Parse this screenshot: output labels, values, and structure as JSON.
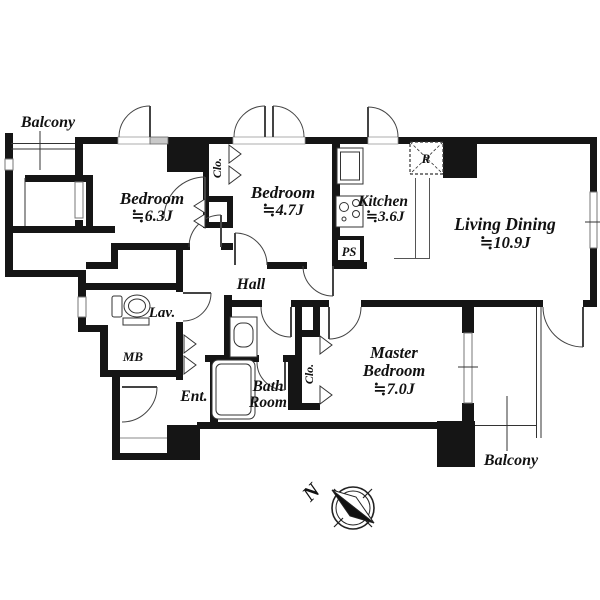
{
  "floorplan": {
    "rooms": {
      "balcony_top": {
        "label": "Balcony"
      },
      "bedroom_1": {
        "name": "Bedroom",
        "size": "≒6.3J"
      },
      "closet_top": {
        "label": "Clo."
      },
      "bedroom_2": {
        "name": "Bedroom",
        "size": "≒4.7J"
      },
      "kitchen": {
        "name": "Kitchen",
        "size": "≒3.6J"
      },
      "refrigerator": {
        "label": "R"
      },
      "pipe_shaft": {
        "label": "PS"
      },
      "living_dining": {
        "name": "Living Dining",
        "size": "≒10.9J"
      },
      "hall": {
        "label": "Hall"
      },
      "lavatory": {
        "label": "Lav."
      },
      "meter_box": {
        "label": "MB"
      },
      "entrance": {
        "label": "Ent."
      },
      "bathroom": {
        "name_line1": "Bath",
        "name_line2": "Room"
      },
      "closet_master": {
        "label": "Clo."
      },
      "master_bedroom": {
        "name_line1": "Master",
        "name_line2": "Bedroom",
        "size": "≒7.0J"
      },
      "balcony_bottom": {
        "label": "Balcony"
      }
    },
    "compass": {
      "north_label": "N"
    },
    "colors": {
      "wall": "#151515",
      "line": "#333333",
      "background": "#ffffff"
    }
  }
}
